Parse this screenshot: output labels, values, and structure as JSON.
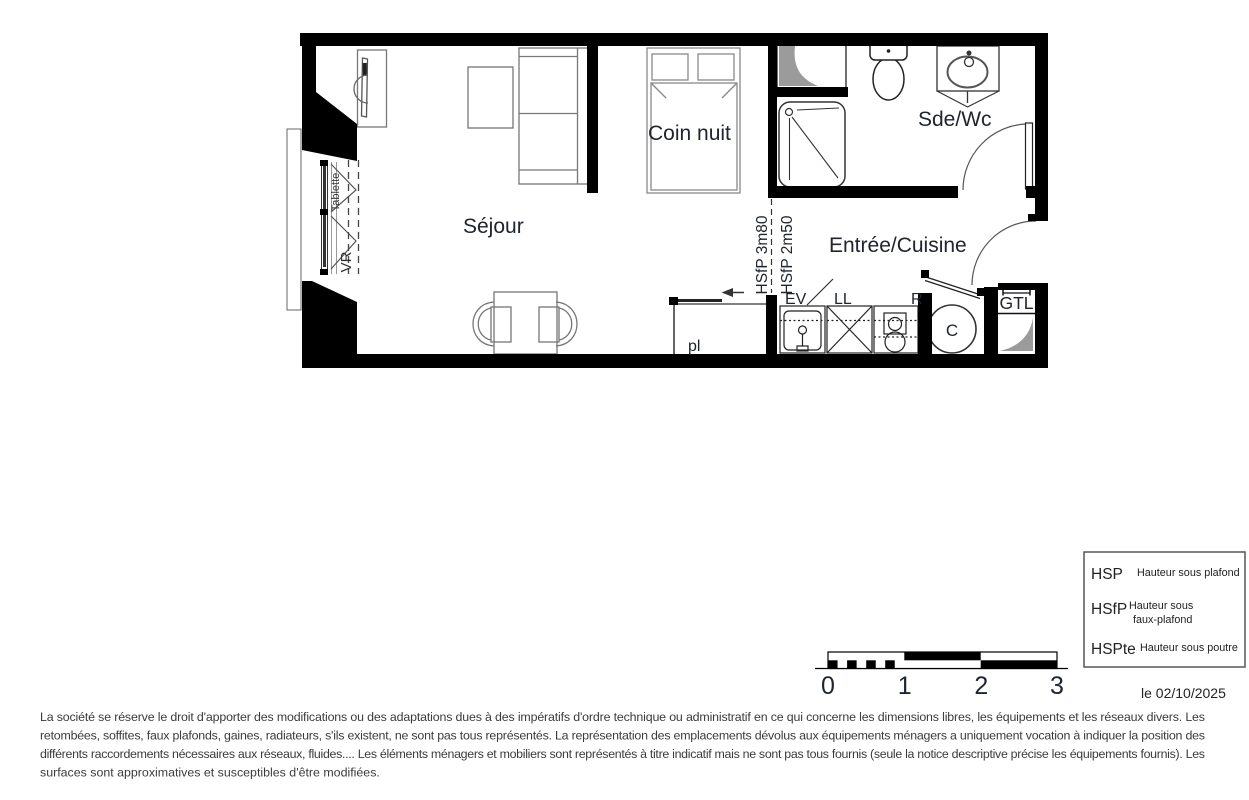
{
  "plan": {
    "rooms": {
      "sejour": "Séjour",
      "coin_nuit": "Coin nuit",
      "sde_wc": "Sde/Wc",
      "entree_cuisine": "Entrée/Cuisine"
    },
    "labels": {
      "tablette": "Tablette",
      "vr": "VR",
      "hsfp_3m80": "HSfP 3m80",
      "hsfp_2m50": "HSfP 2m50",
      "pl": "pl",
      "ev": "EV",
      "ll": "LL",
      "r": "R",
      "c": "C",
      "gtl": "GTL"
    },
    "colors": {
      "wall": "#000000",
      "label_text": "#20242e",
      "shading_gray": "#9b9b9b"
    }
  },
  "scale_bar": {
    "ticks": [
      "0",
      "1",
      "2",
      "3"
    ]
  },
  "legend": {
    "items": [
      {
        "abbr": "HSP",
        "lines": [
          "Hauteur sous plafond"
        ]
      },
      {
        "abbr": "HSfP",
        "lines": [
          "Hauteur sous",
          "faux-plafond"
        ]
      },
      {
        "abbr": "HSPte",
        "lines": [
          "Hauteur sous poutre"
        ]
      }
    ],
    "date": "le 02/10/2025"
  },
  "disclaimer": {
    "lines": [
      "La société se réserve le droit d'apporter des modifications ou des adaptations dues à des impératifs d'ordre technique ou administratif en ce qui concerne les dimensions libres, les équipements et les réseaux divers. Les",
      "retombées, soffites, faux plafonds, gaines, radiateurs, s'ils existent, ne sont pas tous représentés. La représentation des emplacements dévolus aux équipements ménagers a uniquement vocation à indiquer la position des",
      "différents raccordements nécessaires aux réseaux, fluides.... Les éléments ménagers et mobiliers sont représentés à titre indicatif mais ne sont pas tous fournis (seule la notice descriptive précise les équipements fournis). Les",
      "surfaces sont approximatives et susceptibles d'être modifiées."
    ]
  }
}
